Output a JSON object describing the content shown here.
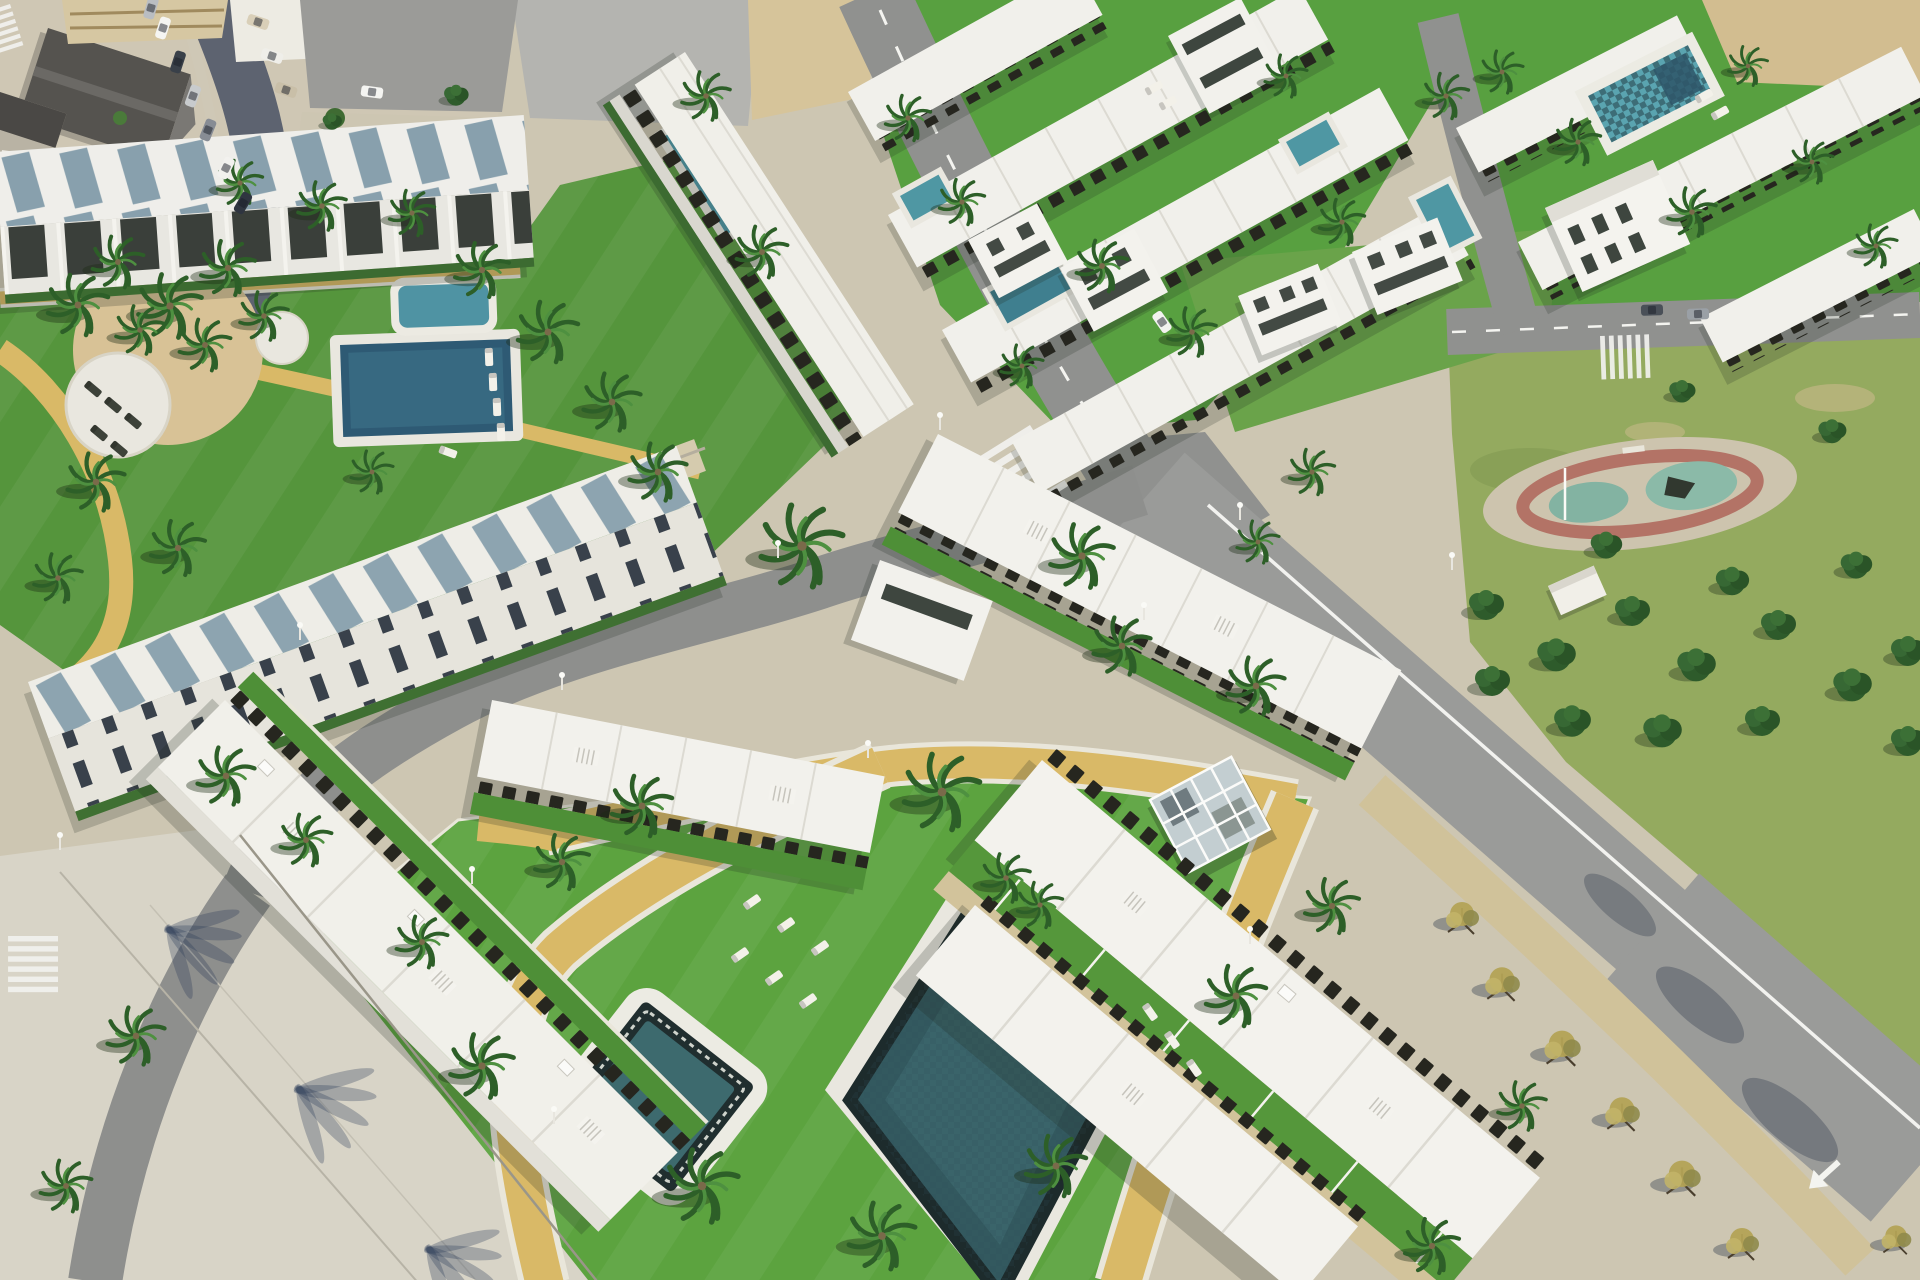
{
  "meta": {
    "title": "Aerial render of a coastal residential development",
    "description": "Computer-generated aerial view of a modern white low-rise residential complex: rows of flat-roofed apartments and townhouses with dark pergolas, communal lawns with swimming pools, a jacuzzi, a glass gazebo, sun loungers, sandy curving footpaths, palm trees, a public park with pine trees and a playground, asphalt roads with crosswalks and lane arrows, and an older town block with parked cars in the top-left corner."
  },
  "palette": {
    "lawn_bright": "#5ca33f",
    "lawn_mid": "#55953c",
    "park_green": "#94aa5f",
    "path_sand": "#d9b967",
    "deck_white": "#e9e7df",
    "building_white": "#f2f1ec",
    "pergola_dark": "#26261f",
    "roof_panel_blue": "#7c97a6",
    "pool_dark_water": "#33595f",
    "pool_tile": "#1d2b2c",
    "pool_teal": "#4f97a3",
    "road_gray": "#90918f",
    "old_street": "#5d6370",
    "concrete": "#cdc6b2",
    "promenade": "#d8d4c7",
    "sand": "#d2bd90",
    "playground_track_red": "#b06a5e",
    "playground_teal": "#83b3a2"
  },
  "scene": {
    "palms": [
      [
        78,
        305,
        1.0
      ],
      [
        118,
        262,
        0.85
      ],
      [
        170,
        306,
        1.05
      ],
      [
        228,
        268,
        0.9
      ],
      [
        264,
        316,
        0.8
      ],
      [
        322,
        206,
        0.8
      ],
      [
        240,
        183,
        0.75
      ],
      [
        412,
        213,
        0.75
      ],
      [
        482,
        270,
        0.9
      ],
      [
        548,
        332,
        1.0
      ],
      [
        612,
        402,
        0.95
      ],
      [
        658,
        472,
        0.95
      ],
      [
        96,
        482,
        0.95
      ],
      [
        178,
        548,
        0.9
      ],
      [
        58,
        578,
        0.8
      ],
      [
        372,
        472,
        0.7
      ],
      [
        140,
        330,
        0.8
      ],
      [
        205,
        345,
        0.85
      ],
      [
        706,
        96,
        0.8
      ],
      [
        762,
        252,
        0.85
      ],
      [
        908,
        118,
        0.75
      ],
      [
        962,
        202,
        0.75
      ],
      [
        1102,
        266,
        0.85
      ],
      [
        1192,
        332,
        0.8
      ],
      [
        1022,
        366,
        0.7
      ],
      [
        1342,
        222,
        0.75
      ],
      [
        1446,
        96,
        0.75
      ],
      [
        1286,
        76,
        0.7
      ],
      [
        1502,
        72,
        0.7
      ],
      [
        1578,
        142,
        0.75
      ],
      [
        1692,
        212,
        0.8
      ],
      [
        1812,
        162,
        0.7
      ],
      [
        1876,
        246,
        0.7
      ],
      [
        1748,
        66,
        0.65
      ],
      [
        1312,
        472,
        0.75
      ],
      [
        1258,
        542,
        0.7
      ],
      [
        802,
        546,
        1.35
      ],
      [
        1082,
        556,
        1.05
      ],
      [
        942,
        792,
        1.25
      ],
      [
        1122,
        646,
        0.95
      ],
      [
        1256,
        686,
        0.95
      ],
      [
        642,
        806,
        1.0
      ],
      [
        562,
        862,
        0.9
      ],
      [
        482,
        1066,
        1.05
      ],
      [
        702,
        1186,
        1.2
      ],
      [
        882,
        1236,
        1.1
      ],
      [
        1056,
        1166,
        1.0
      ],
      [
        1236,
        996,
        1.0
      ],
      [
        1332,
        906,
        0.9
      ],
      [
        226,
        776,
        0.95
      ],
      [
        306,
        840,
        0.85
      ],
      [
        136,
        1036,
        0.95
      ],
      [
        66,
        1186,
        0.85
      ],
      [
        1432,
        1246,
        0.9
      ],
      [
        1522,
        1106,
        0.8
      ],
      [
        422,
        942,
        0.85
      ],
      [
        1006,
        878,
        0.8
      ],
      [
        1040,
        905,
        0.75
      ]
    ],
    "pines": [
      [
        1486,
        606,
        1
      ],
      [
        1556,
        656,
        1.1
      ],
      [
        1632,
        612,
        1
      ],
      [
        1696,
        666,
        1.1
      ],
      [
        1778,
        626,
        1
      ],
      [
        1852,
        686,
        1.1
      ],
      [
        1606,
        546,
        0.9
      ],
      [
        1856,
        566,
        0.9
      ],
      [
        1908,
        652,
        1
      ],
      [
        1732,
        582,
        0.95
      ],
      [
        1492,
        682,
        1
      ],
      [
        1572,
        722,
        1.05
      ],
      [
        1662,
        732,
        1.1
      ],
      [
        1762,
        722,
        1
      ],
      [
        1908,
        742,
        1
      ],
      [
        1832,
        432,
        0.8
      ],
      [
        1682,
        392,
        0.75
      ],
      [
        456,
        96,
        0.7
      ],
      [
        332,
        122,
        0.55
      ]
    ],
    "autumn_trees": [
      [
        1462,
        916,
        1
      ],
      [
        1502,
        982,
        1.05
      ],
      [
        1562,
        1046,
        1.1
      ],
      [
        1622,
        1112,
        1.05
      ],
      [
        1682,
        1176,
        1.1
      ],
      [
        1742,
        1242,
        1
      ],
      [
        1896,
        1238,
        0.9
      ]
    ],
    "loungers_white": [
      [
        752,
        902,
        -35
      ],
      [
        786,
        925,
        -35
      ],
      [
        820,
        948,
        -35
      ],
      [
        740,
        955,
        -35
      ],
      [
        774,
        978,
        -35
      ],
      [
        808,
        1001,
        -35
      ],
      [
        1150,
        1012,
        55
      ],
      [
        1172,
        1040,
        55
      ],
      [
        1194,
        1068,
        55
      ],
      [
        489,
        357,
        88
      ],
      [
        493,
        382,
        88
      ],
      [
        497,
        407,
        88
      ],
      [
        501,
        432,
        88
      ],
      [
        1154,
        88,
        -29
      ],
      [
        1168,
        103,
        -29
      ],
      [
        1704,
        96,
        -29
      ],
      [
        1720,
        113,
        -29
      ],
      [
        448,
        452,
        20
      ]
    ],
    "loungers_dark": [
      [
        93,
        389,
        40
      ],
      [
        113,
        405,
        40
      ],
      [
        133,
        421,
        40
      ],
      [
        99,
        433,
        40
      ],
      [
        119,
        449,
        40
      ]
    ],
    "cars": [
      [
        163,
        28,
        -72,
        "#f5f5f2"
      ],
      [
        178,
        62,
        -72,
        "#394049"
      ],
      [
        193,
        96,
        -70,
        "#c8cbcd"
      ],
      [
        208,
        130,
        -68,
        "#878c94"
      ],
      [
        226,
        168,
        -64,
        "#f2f1ee"
      ],
      [
        243,
        203,
        -60,
        "#2f3540"
      ],
      [
        151,
        8,
        -74,
        "#b9bdc2"
      ],
      [
        258,
        22,
        18,
        "#d9cfb8"
      ],
      [
        272,
        56,
        18,
        "#efeee9"
      ],
      [
        286,
        90,
        18,
        "#c9bfa8"
      ],
      [
        372,
        92,
        8,
        "#f4f4f1"
      ],
      [
        1652,
        310,
        -2,
        "#4a5058"
      ],
      [
        1698,
        314,
        -2,
        "#9aa0a6"
      ],
      [
        1162,
        322,
        55,
        "#f2f2ef"
      ]
    ],
    "light_poles": [
      [
        562,
        690
      ],
      [
        778,
        558
      ],
      [
        1144,
        620
      ],
      [
        472,
        884
      ],
      [
        554,
        1124
      ],
      [
        1250,
        944
      ],
      [
        868,
        758
      ],
      [
        300,
        640
      ],
      [
        940,
        430
      ],
      [
        1240,
        520
      ],
      [
        60,
        850
      ],
      [
        1452,
        570
      ]
    ]
  }
}
